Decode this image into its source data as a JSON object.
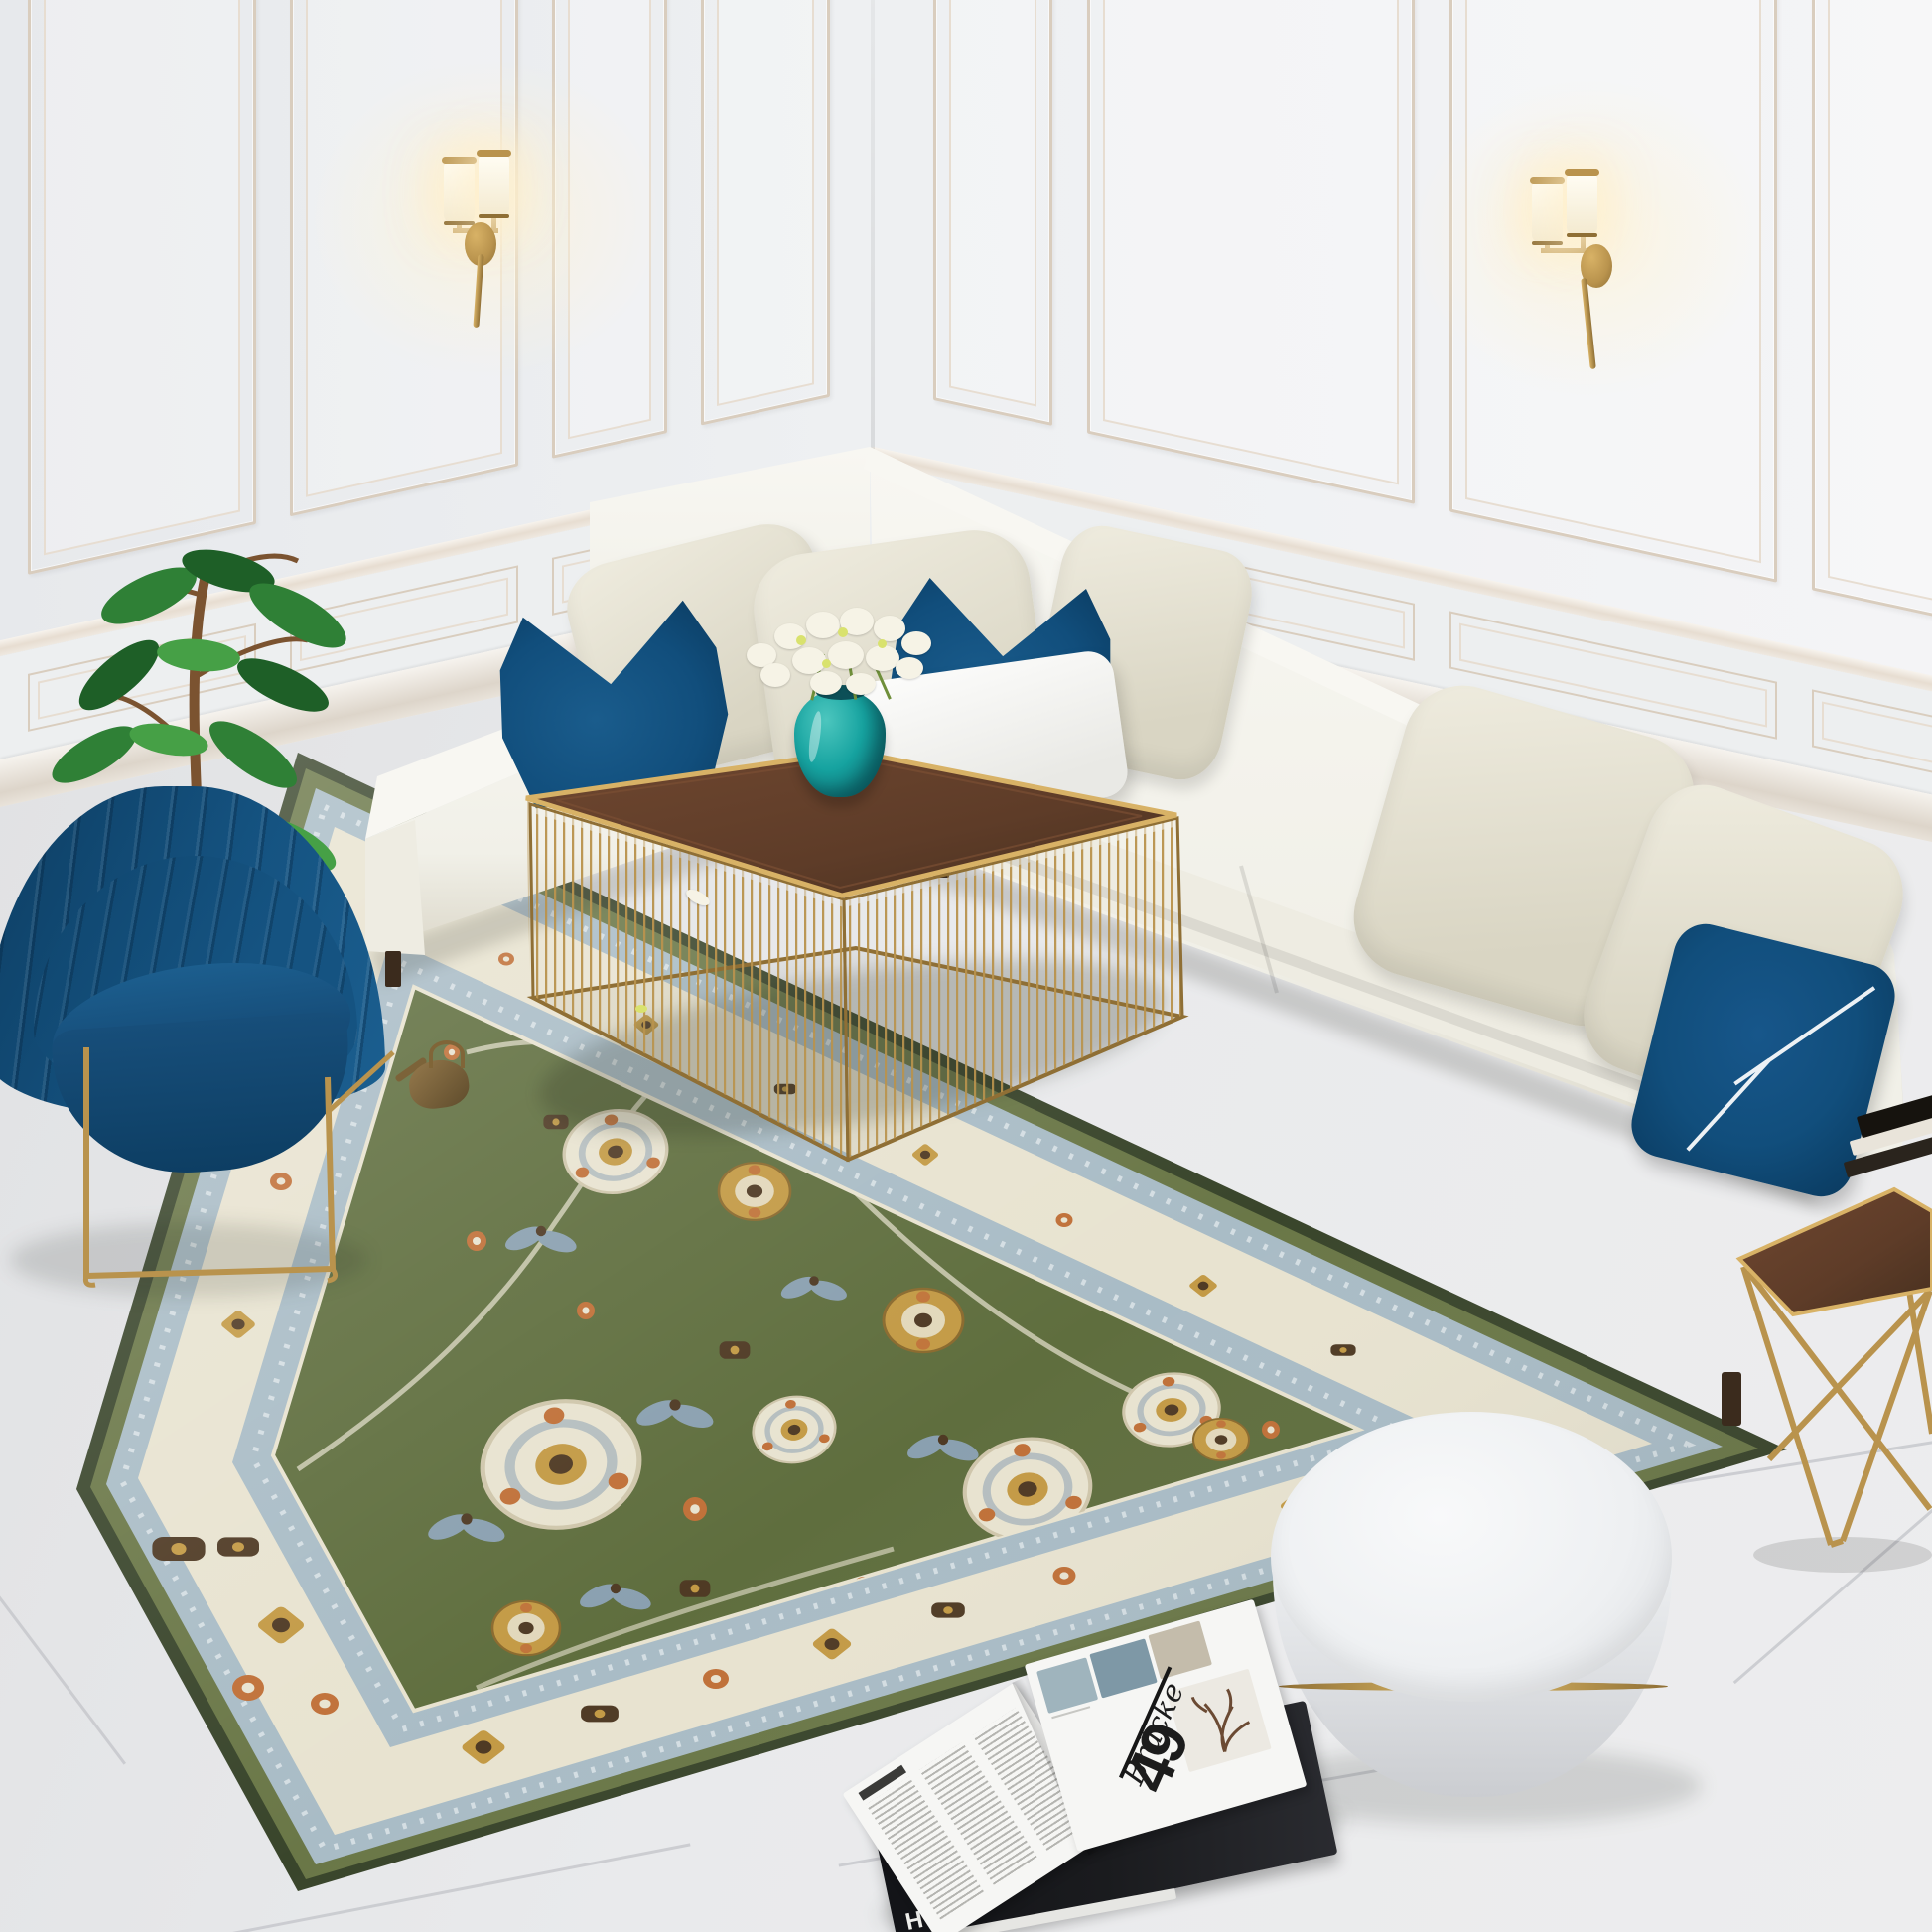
{
  "scene": {
    "setting": "Sunlit classic living room render: white L-shaped sectional with blue accent pillows, blue channel-tufted armchair, green oriental rug, brass wire coffee table with flower vase, round white ottoman, gold side table, paneled walls with twin brass sconces, large tile floor",
    "objects": [
      "white sectional sofa",
      "chaise section",
      "cream back pillows",
      "blue V-fold pillows",
      "white lumbar pillow",
      "blue zigzag pillow",
      "blue accent armchair with gold legs",
      "potted ficus plant",
      "green oriental area rug",
      "brass wire-cage coffee table",
      "teal glass vase with white bouquet",
      "round white ottoman with gold band",
      "gold geometric side table",
      "stacked books",
      "open magazine",
      "black hardcover book",
      "two double-shade brass wall sconces",
      "classic wall paneling",
      "chair rail",
      "baseboard",
      "porcelain tile floor",
      "brass watering can",
      "fallen petals"
    ],
    "colors": {
      "wall": "#eef0f2",
      "wall_deep": "#e7e9ec",
      "molding": "#e7ddd1",
      "molding_shadow": "#d9cdbe",
      "wainscot": "#edeff0",
      "floor": "#e7e8ea",
      "floor_seam": "#c4c6ca",
      "sofa": "#f1f0e8",
      "sofa_bright": "#f8f7f2",
      "sofa_face": "#eeece2",
      "sofa_shade": "#dcd8ca",
      "pillow_cream": "#efecdf",
      "pillow_cream_deep": "#d9d5c3",
      "pillow_white": "#fdfdfc",
      "pillow_blue": "#114e7c",
      "pillow_blue_deep": "#0a3a5f",
      "chair_blue": "#155381",
      "chair_blue_deep": "#0d3e63",
      "brass": "#b9934d",
      "brass_bright": "#d8b266",
      "brass_deep": "#8f6f35",
      "gold_band": "#e2bf6b",
      "wood": "#5e3c28",
      "wood_deep": "#47301f",
      "rug_edge": "#39452b",
      "rug_olive": "#6a7747",
      "rug_blue": "#a9bcc6",
      "rug_cream": "#e8e3d0",
      "rug_field": "#5f6e3e",
      "rug_gold": "#c39a45",
      "rug_orange": "#c07038",
      "rug_brown": "#4f3a24",
      "rug_slate": "#8aa0b0",
      "leaf": "#2f8036",
      "leaf_mid": "#46a046",
      "leaf_dark": "#1e5f27",
      "trunk": "#7b5330",
      "vase": "#16a3a0",
      "vase_deep": "#0c6f74",
      "flower_white": "#f6f3e6",
      "flower_accent": "#d9e26e",
      "ottoman_top": "#eef0f2",
      "ottoman_side": "#dfe1e4",
      "book_black": "#1a1b1e",
      "page": "#e6e6e3",
      "text_dark": "#1c1c1c"
    }
  },
  "magazine": {
    "feature_word": "Brücke",
    "feature_number": "49",
    "book_spine": "HAY"
  }
}
